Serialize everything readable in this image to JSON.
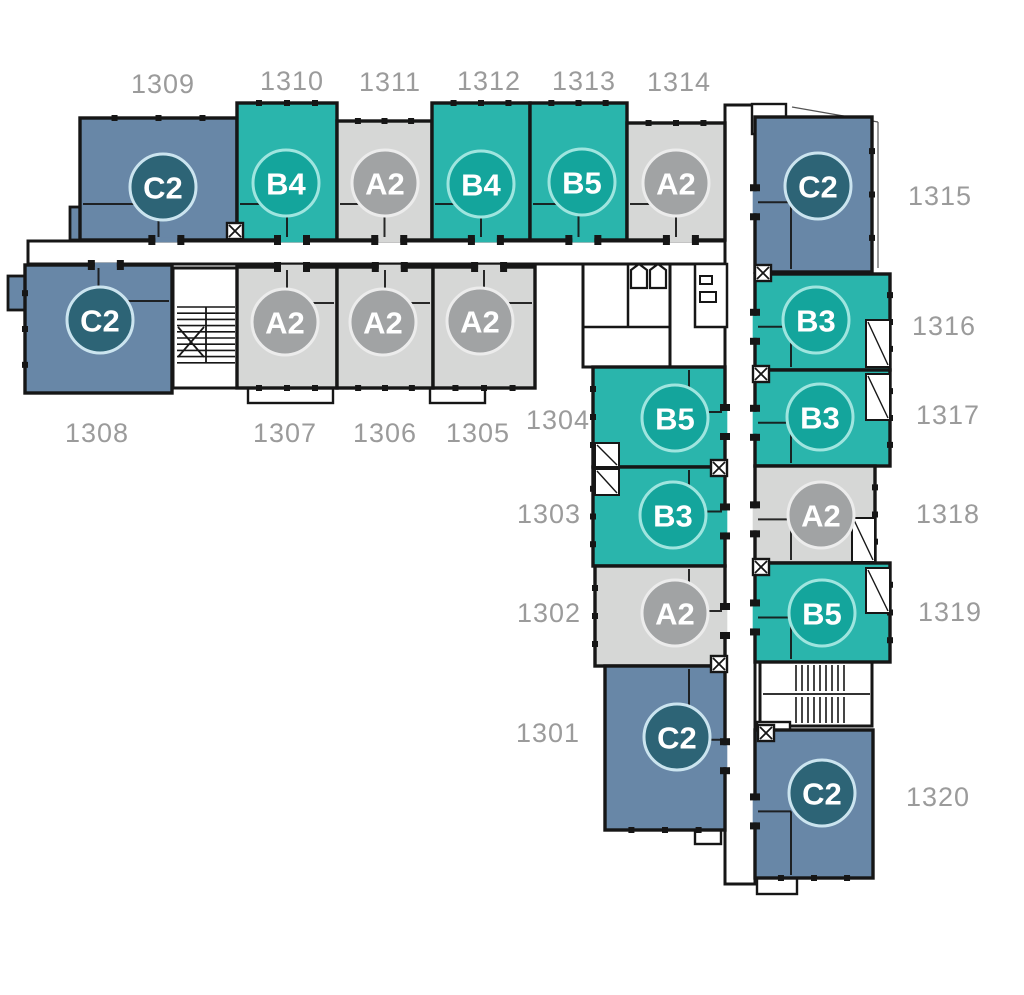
{
  "plan": {
    "title": "Floor plan level 13 units 1301-1320",
    "canvas": {
      "w": 1024,
      "h": 995
    },
    "colors": {
      "bg": "#ffffff",
      "wall": "#161616",
      "number_label": "#9b9b9b",
      "badge_text": "#ffffff",
      "blue_fill": "#6887a7",
      "blue_badge": "#2d6476",
      "blue_ring": "#cbe4ef",
      "teal_fill": "#2ab5ac",
      "teal_badge": "#14a59c",
      "teal_ring": "#9fe5df",
      "gray_fill": "#d6d7d6",
      "gray_badge": "#a1a3a4",
      "gray_ring": "#ececec"
    },
    "units": [
      {
        "number": "1309",
        "type": "C2",
        "category": "blue",
        "rect": [
          80,
          118,
          157,
          122
        ],
        "badge": [
          163,
          187
        ],
        "label": [
          163,
          84
        ],
        "door": "bottom",
        "ext": "top"
      },
      {
        "number": "1310",
        "type": "B4",
        "category": "teal",
        "rect": [
          237,
          103,
          100,
          137
        ],
        "badge": [
          286,
          183
        ],
        "label": [
          292,
          81
        ],
        "door": "bottom",
        "ext": "top"
      },
      {
        "number": "1311",
        "type": "A2",
        "category": "gray",
        "rect": [
          337,
          121,
          95,
          119
        ],
        "badge": [
          385,
          183
        ],
        "label": [
          390,
          82
        ],
        "door": "bottom",
        "ext": "top"
      },
      {
        "number": "1312",
        "type": "B4",
        "category": "teal",
        "rect": [
          432,
          103,
          98,
          137
        ],
        "badge": [
          481,
          184
        ],
        "label": [
          489,
          81
        ],
        "door": "bottom",
        "ext": "top"
      },
      {
        "number": "1313",
        "type": "B5",
        "category": "teal",
        "rect": [
          530,
          103,
          97,
          137
        ],
        "badge": [
          582,
          182
        ],
        "label": [
          584,
          81
        ],
        "door": "bottom",
        "ext": "top"
      },
      {
        "number": "1314",
        "type": "A2",
        "category": "gray",
        "rect": [
          627,
          123,
          98,
          117
        ],
        "badge": [
          676,
          183
        ],
        "label": [
          679,
          82
        ],
        "door": "bottom",
        "ext": "top"
      },
      {
        "number": "1315",
        "type": "C2",
        "category": "blue",
        "rect": [
          755,
          117,
          117,
          155
        ],
        "badge": [
          818,
          186
        ],
        "label": [
          940,
          196
        ],
        "door": "left",
        "ext": "right"
      },
      {
        "number": "1316",
        "type": "B3",
        "category": "teal",
        "rect": [
          755,
          274,
          135,
          96
        ],
        "badge": [
          816,
          320
        ],
        "label": [
          944,
          326
        ],
        "door": "left",
        "ext": "right"
      },
      {
        "number": "1317",
        "type": "B3",
        "category": "teal",
        "rect": [
          755,
          370,
          135,
          96
        ],
        "badge": [
          820,
          417
        ],
        "label": [
          948,
          415
        ],
        "door": "left",
        "ext": "right"
      },
      {
        "number": "1318",
        "type": "A2",
        "category": "gray",
        "rect": [
          755,
          466,
          120,
          97
        ],
        "badge": [
          821,
          515
        ],
        "label": [
          948,
          514
        ],
        "door": "left",
        "ext": "right"
      },
      {
        "number": "1319",
        "type": "B5",
        "category": "teal",
        "rect": [
          755,
          563,
          135,
          99
        ],
        "badge": [
          822,
          613
        ],
        "label": [
          950,
          612
        ],
        "door": "left",
        "ext": "right"
      },
      {
        "number": "1320",
        "type": "C2",
        "category": "blue",
        "rect": [
          755,
          730,
          118,
          148
        ],
        "badge": [
          822,
          793
        ],
        "label": [
          938,
          797
        ],
        "door": "left",
        "ext": "bottom"
      },
      {
        "number": "1308",
        "type": "C2",
        "category": "blue",
        "rect": [
          25,
          265,
          147,
          128
        ],
        "badge": [
          100,
          320
        ],
        "label": [
          97,
          433
        ],
        "door": "top",
        "ext": "left"
      },
      {
        "number": "1307",
        "type": "A2",
        "category": "gray",
        "rect": [
          237,
          267,
          100,
          121
        ],
        "badge": [
          285,
          322
        ],
        "label": [
          285,
          433
        ],
        "door": "top",
        "ext": "bottom"
      },
      {
        "number": "1306",
        "type": "A2",
        "category": "gray",
        "rect": [
          337,
          267,
          96,
          121
        ],
        "badge": [
          383,
          322
        ],
        "label": [
          385,
          433
        ],
        "door": "top",
        "ext": "bottom"
      },
      {
        "number": "1305",
        "type": "A2",
        "category": "gray",
        "rect": [
          433,
          267,
          102,
          121
        ],
        "badge": [
          480,
          321
        ],
        "label": [
          478,
          433
        ],
        "door": "top",
        "ext": "bottom"
      },
      {
        "number": "1304",
        "type": "B5",
        "category": "teal",
        "rect": [
          593,
          367,
          132,
          100
        ],
        "badge": [
          675,
          418
        ],
        "label": [
          558,
          420
        ],
        "door": "right",
        "ext": "left"
      },
      {
        "number": "1303",
        "type": "B3",
        "category": "teal",
        "rect": [
          593,
          467,
          132,
          99
        ],
        "badge": [
          673,
          515
        ],
        "label": [
          549,
          514
        ],
        "door": "right",
        "ext": "left"
      },
      {
        "number": "1302",
        "type": "A2",
        "category": "gray",
        "rect": [
          595,
          566,
          130,
          100
        ],
        "badge": [
          675,
          613
        ],
        "label": [
          549,
          613
        ],
        "door": "right",
        "ext": "left"
      },
      {
        "number": "1301",
        "type": "C2",
        "category": "blue",
        "rect": [
          605,
          666,
          120,
          164
        ],
        "badge": [
          677,
          737
        ],
        "label": [
          548,
          733
        ],
        "door": "right",
        "ext": "bottom"
      }
    ],
    "corridors": [
      {
        "name": "corridor-horizontal",
        "rect": [
          28,
          241,
          697,
          23
        ]
      },
      {
        "name": "corridor-vertical",
        "rect": [
          725,
          105,
          30,
          779
        ]
      }
    ],
    "stairwells": [
      {
        "name": "stairwell-west",
        "box": [
          173,
          268,
          64,
          120
        ],
        "hbands": [
          {
            "y1": 307,
            "y2": 363,
            "step": 6.2,
            "x1": 177,
            "x2": 235
          }
        ],
        "vbands": [],
        "lines": [
          [
            206,
            307,
            206,
            363
          ],
          [
            178,
            327,
            204,
            357
          ],
          [
            178,
            357,
            204,
            327
          ]
        ]
      },
      {
        "name": "stairwell-east",
        "box": [
          760,
          662,
          112,
          64
        ],
        "hbands": [],
        "vbands": [
          {
            "x1": 796,
            "x2": 846,
            "step": 6,
            "y1": 665,
            "y2": 691
          },
          {
            "x1": 796,
            "x2": 846,
            "step": 6,
            "y1": 697,
            "y2": 723
          }
        ],
        "lines": [
          [
            763,
            694,
            870,
            694
          ]
        ]
      }
    ],
    "elevator_core": {
      "room1": [
        583,
        264,
        87,
        103
      ],
      "room2": [
        695,
        264,
        32,
        63
      ],
      "lines": [
        [
          628,
          264,
          628,
          327
        ],
        [
          583,
          327,
          670,
          327
        ]
      ],
      "cars": [
        [
          631,
          264
        ],
        [
          650,
          264
        ]
      ],
      "fixtures": [
        [
          700,
          276,
          12,
          8
        ],
        [
          700,
          292,
          16,
          10
        ]
      ]
    },
    "white_annexes": [
      [
        248,
        388,
        85,
        15
      ],
      [
        430,
        388,
        55,
        15
      ],
      [
        752,
        104,
        34,
        30
      ],
      [
        695,
        830,
        26,
        14
      ],
      [
        757,
        874,
        40,
        20
      ],
      [
        757,
        722,
        33,
        30
      ]
    ],
    "balcony_notches": [
      [
        866,
        320,
        24,
        47
      ],
      [
        866,
        374,
        24,
        46
      ],
      [
        852,
        518,
        23,
        44
      ],
      [
        866,
        568,
        24,
        45
      ],
      [
        595,
        443,
        24,
        24
      ],
      [
        595,
        469,
        24,
        26
      ]
    ],
    "blue_annexes": [
      [
        70,
        207,
        32,
        33
      ],
      [
        8,
        276,
        20,
        34
      ]
    ],
    "shaft_symbols": [
      [
        235,
        231
      ],
      [
        763,
        273
      ],
      [
        761,
        374
      ],
      [
        761,
        567
      ],
      [
        719,
        468
      ],
      [
        719,
        664
      ],
      [
        766,
        733
      ]
    ],
    "thin_lines": [
      [
        878,
        122,
        878,
        268
      ],
      [
        792,
        107,
        878,
        122
      ]
    ]
  }
}
